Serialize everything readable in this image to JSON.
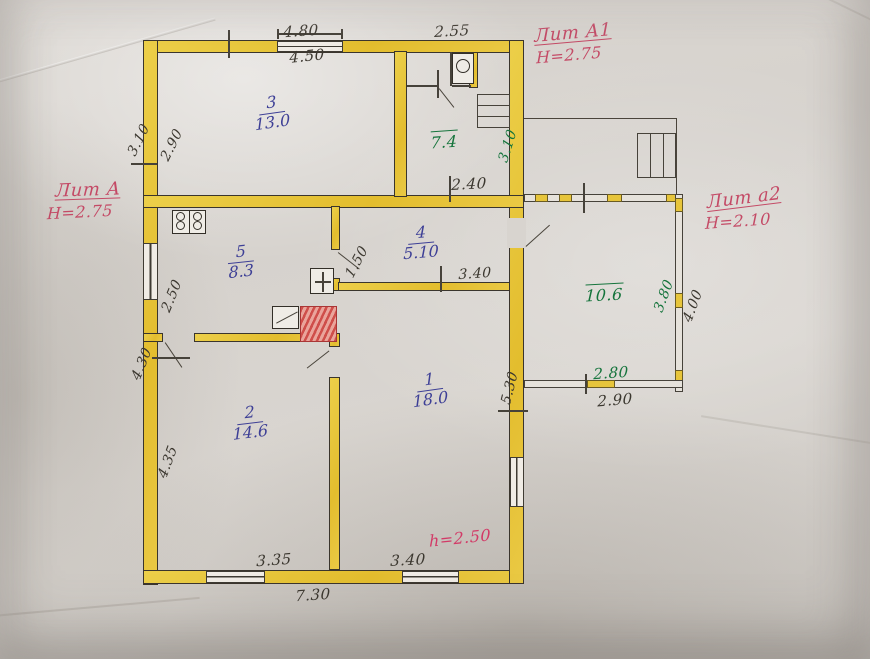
{
  "plan": {
    "litera": {
      "a": {
        "name": "Лит А",
        "height": "Н=2.75"
      },
      "a1": {
        "name": "Лит А1",
        "height": "Н=2.75"
      },
      "a2": {
        "name": "Лит а2",
        "height": "Н=2.10"
      }
    },
    "rooms": {
      "r1": {
        "number": "1",
        "area": "18.0"
      },
      "r2": {
        "number": "2",
        "area": "14.6"
      },
      "r3": {
        "number": "3",
        "area": "13.0"
      },
      "r4": {
        "number": "4",
        "area": "5.10"
      },
      "r5": {
        "number": "5",
        "area": "8.3"
      },
      "hall": {
        "area": "7.4"
      },
      "veranda": {
        "area": "10.6"
      }
    },
    "notes": {
      "ceiling_height": "h=2.50"
    },
    "dims": {
      "top_outer": "4.80",
      "top_inner": "4.50",
      "top_small": "2.55",
      "left_upper_outer": "3.10",
      "left_upper_inner": "2.90",
      "room5_left": "2.50",
      "left_lower_outer": "4.30",
      "left_lower_inner": "4.35",
      "hall_bottom": "2.40",
      "hall_right": "3.10",
      "room4_left": "1.50",
      "room4_bottom": "3.40",
      "room1_right": "5.30",
      "bottom_room2": "3.35",
      "bottom_room1": "3.40",
      "bottom_outer": "7.30",
      "veranda_bottom_inner": "2.80",
      "veranda_bottom_outer": "2.90",
      "veranda_right_inner": "3.80",
      "veranda_right_outer": "4.00"
    },
    "colors": {
      "ink_blue": "#3d3f96",
      "ink_green": "#15743c",
      "ink_red": "#c44a66",
      "wall_fill": "#e8c53a"
    }
  }
}
